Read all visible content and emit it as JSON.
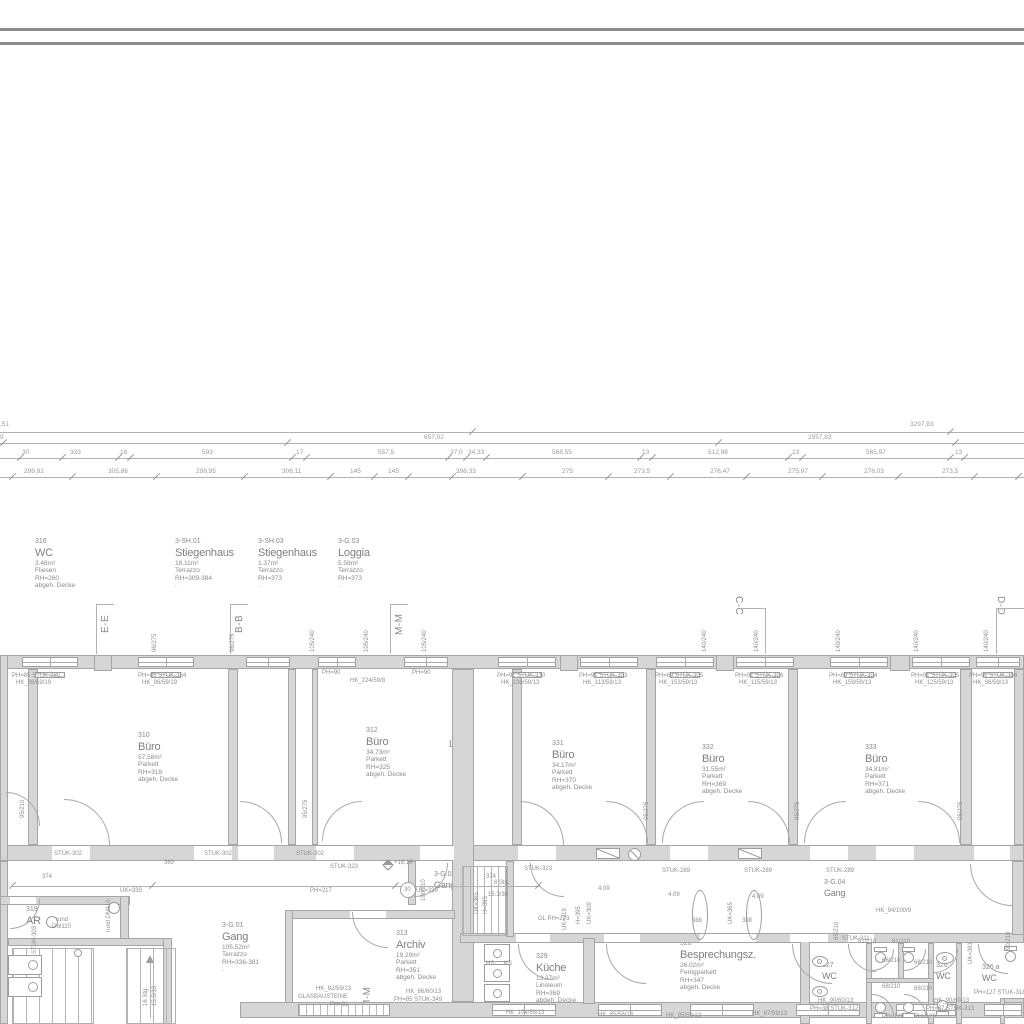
{
  "colors": {
    "wall_fill": "#d6d6d6",
    "wall_edge": "#a6a6a6",
    "line": "#b2b2b2",
    "text": "#8f8f8f",
    "border": "#8c8c8c"
  },
  "rooms": {
    "r316": {
      "num": "316",
      "name": "WC",
      "area": "3.48m²",
      "floor": "Fliesen",
      "rh": "RH=260",
      "ceiling": "abgeh. Decke"
    },
    "sh01": {
      "num": "3-SH.01",
      "name": "Stiegenhaus",
      "area": "18.11m²",
      "floor": "Terrazzo",
      "rh": "RH=309-384",
      "ceiling": "."
    },
    "sh03": {
      "num": "3-SH.03",
      "name": "Stiegenhaus",
      "area": "1.37m²",
      "floor": "Terrazzo",
      "rh": "RH=373",
      "ceiling": "."
    },
    "g03": {
      "num": "3-G.03",
      "name": "Loggia",
      "area": "5.58m²",
      "floor": "Terrazzo",
      "rh": "RH=373",
      "ceiling": "."
    },
    "r310": {
      "num": "310",
      "name": "Büro",
      "area": "57.58m²",
      "floor": "Parkett",
      "rh": "RH=318",
      "ceiling": "abgeh. Decke"
    },
    "r312": {
      "num": "312",
      "name": "Büro",
      "area": "34.73m²",
      "floor": "Parkett",
      "rh": "RH=325",
      "ceiling": "abgeh. Decke"
    },
    "r331": {
      "num": "331",
      "name": "Büro",
      "area": "34.17m²",
      "floor": "Parkett",
      "rh": "RH=370",
      "ceiling": "abgeh. Decke"
    },
    "r332": {
      "num": "332",
      "name": "Büro",
      "area": "31.55m²",
      "floor": "Parkett",
      "rh": "RH=369",
      "ceiling": "abgeh. Decke"
    },
    "r333": {
      "num": "333",
      "name": "Büro",
      "area": "34.81m²",
      "floor": "Parkett",
      "rh": "RH=371",
      "ceiling": "abgeh. Decke"
    },
    "g01": {
      "num": "3-G.01",
      "name": "Gang",
      "area": "105.52m²",
      "floor": "Terrazzo",
      "rh": "RH=336-381",
      "ceiling": "."
    },
    "r313": {
      "num": "313",
      "name": "Archiv",
      "area": "19.29m²",
      "floor": "Parkett",
      "rh": "RH=351",
      "ceiling": "abgeh. Decke"
    },
    "r329": {
      "num": "329",
      "name": "Küche",
      "area": "13.27m²",
      "floor": "Linoleum",
      "rh": "RH=369",
      "ceiling": "abgeh. Decke"
    },
    "r328": {
      "num": "328",
      "name": "Besprechungsz.",
      "area": "26.02m²",
      "floor": "Fertigparkett",
      "rh": "RH=347",
      "ceiling": "abgeh. Decke"
    },
    "r319": {
      "num": "319",
      "name": "AR"
    },
    "g02": {
      "num": "3-G.02",
      "name": "Gang"
    },
    "g04": {
      "num": "3-G.04",
      "name": "Gang"
    },
    "r327": {
      "num": "327",
      "name": "WC"
    },
    "r326": {
      "num": "326",
      "name": "WC"
    },
    "r326a": {
      "num": "326 a",
      "name": "WC"
    }
  },
  "section_markers": {
    "ee": "E-E",
    "bb": "B-B",
    "mm": "M-M",
    "cc": "C-C",
    "dd": "D-D",
    "ll": "L-L",
    "mm_bottom": "M-M"
  },
  "dimensions": {
    "rows": [
      [
        {
          "t": ",51",
          "x": 0
        },
        {
          "t": "3297,83",
          "x": 910
        }
      ],
      [
        {
          "t": "9",
          "x": 0
        },
        {
          "t": "657,02",
          "x": 424
        },
        {
          "t": "2557,83",
          "x": 808
        }
      ],
      [
        {
          "t": "30",
          "x": 22
        },
        {
          "t": "333",
          "x": 70
        },
        {
          "t": "18",
          "x": 120
        },
        {
          "t": "593",
          "x": 202
        },
        {
          "t": "17",
          "x": 296
        },
        {
          "t": "557,5",
          "x": 378
        },
        {
          "t": "37,0",
          "x": 450
        },
        {
          "t": "34,33",
          "x": 468
        },
        {
          "t": "568,55",
          "x": 552
        },
        {
          "t": "13",
          "x": 642
        },
        {
          "t": "512,98",
          "x": 708
        },
        {
          "t": "13",
          "x": 792
        },
        {
          "t": "565,97",
          "x": 866
        },
        {
          "t": "13",
          "x": 955
        }
      ],
      [
        {
          "t": "299,92",
          "x": 24
        },
        {
          "t": "305,86",
          "x": 108
        },
        {
          "t": "299,95",
          "x": 196
        },
        {
          "t": "306,11",
          "x": 282
        },
        {
          "t": "145",
          "x": 350
        },
        {
          "t": "145",
          "x": 388
        },
        {
          "t": "396,33",
          "x": 456
        },
        {
          "t": "275",
          "x": 562
        },
        {
          "t": "273,5",
          "x": 634
        },
        {
          "t": "276,47",
          "x": 710
        },
        {
          "t": "275,97",
          "x": 788
        },
        {
          "t": "276,03",
          "x": 864
        },
        {
          "t": "273,5",
          "x": 942
        }
      ]
    ]
  },
  "annotations": [
    {
      "t": "PH=85 STUK-380",
      "x": 12,
      "y": 673
    },
    {
      "t": "HK_86/59/19",
      "x": 16,
      "y": 680
    },
    {
      "t": "PH=85 STUK-384",
      "x": 138,
      "y": 673
    },
    {
      "t": "HK_96/59/19",
      "x": 142,
      "y": 680
    },
    {
      "t": "PH=90",
      "x": 322,
      "y": 670
    },
    {
      "t": "HK_224/59/8",
      "x": 350,
      "y": 678
    },
    {
      "t": "PH=90",
      "x": 412,
      "y": 670
    },
    {
      "t": "PH=91 STUK-310",
      "x": 497,
      "y": 673
    },
    {
      "t": "HK_136/59/13",
      "x": 501,
      "y": 680
    },
    {
      "t": "PH=91 STUK-303",
      "x": 579,
      "y": 673
    },
    {
      "t": "HK_113/59/13",
      "x": 583,
      "y": 680
    },
    {
      "t": "PH=89 STUK-305",
      "x": 655,
      "y": 673
    },
    {
      "t": "HK_153/59/13",
      "x": 659,
      "y": 680
    },
    {
      "t": "PH=91 STUK-306",
      "x": 735,
      "y": 673
    },
    {
      "t": "HK_115/59/13",
      "x": 739,
      "y": 680
    },
    {
      "t": "PH=89 STUK-304",
      "x": 829,
      "y": 673
    },
    {
      "t": "HK_159/59/13",
      "x": 833,
      "y": 680
    },
    {
      "t": "PH=91 STUK-305",
      "x": 911,
      "y": 673
    },
    {
      "t": "HK_125/59/13",
      "x": 915,
      "y": 680
    },
    {
      "t": "PH=96 STUK-304",
      "x": 969,
      "y": 673
    },
    {
      "t": "HK_96/59/13",
      "x": 973,
      "y": 680
    },
    {
      "t": "96/275",
      "x": 152,
      "y": 652,
      "r": -90
    },
    {
      "t": "96/275",
      "x": 230,
      "y": 652,
      "r": -90
    },
    {
      "t": "105/240",
      "x": 310,
      "y": 652,
      "r": -90
    },
    {
      "t": "105/240",
      "x": 364,
      "y": 652,
      "r": -90
    },
    {
      "t": "105/240",
      "x": 422,
      "y": 652,
      "r": -90
    },
    {
      "t": "140/240",
      "x": 702,
      "y": 652,
      "r": -90
    },
    {
      "t": "140/240",
      "x": 754,
      "y": 652,
      "r": -90
    },
    {
      "t": "140/240",
      "x": 836,
      "y": 652,
      "r": -90
    },
    {
      "t": "140/240",
      "x": 914,
      "y": 652,
      "r": -90
    },
    {
      "t": "140/240",
      "x": 984,
      "y": 652,
      "r": -90
    },
    {
      "t": "STUK-302",
      "x": 54,
      "y": 851
    },
    {
      "t": "STUK-302",
      "x": 204,
      "y": 851
    },
    {
      "t": "STUK-302",
      "x": 296,
      "y": 851
    },
    {
      "t": "369",
      "x": 164,
      "y": 860
    },
    {
      "t": "STUK-323",
      "x": 330,
      "y": 864
    },
    {
      "t": "STUK-323",
      "x": 524,
      "y": 866
    },
    {
      "t": "STUK-289",
      "x": 662,
      "y": 868
    },
    {
      "t": "STUK-289",
      "x": 744,
      "y": 868
    },
    {
      "t": "STUK-289",
      "x": 826,
      "y": 868
    },
    {
      "t": "95/275",
      "x": 303,
      "y": 818,
      "r": -90
    },
    {
      "t": "95/275",
      "x": 644,
      "y": 820,
      "r": -90
    },
    {
      "t": "95/275",
      "x": 795,
      "y": 820,
      "r": -90
    },
    {
      "t": "95/275",
      "x": 958,
      "y": 820,
      "r": -90
    },
    {
      "t": "95/210",
      "x": 20,
      "y": 818,
      "r": -90
    },
    {
      "t": "374",
      "x": 42,
      "y": 874
    },
    {
      "t": "374",
      "x": 486,
      "y": 874
    },
    {
      "t": "UK=339",
      "x": 120,
      "y": 888
    },
    {
      "t": "PH=217",
      "x": 310,
      "y": 888
    },
    {
      "t": "UK=339",
      "x": 416,
      "y": 888
    },
    {
      "t": "UK=319",
      "x": 562,
      "y": 930,
      "r": -90
    },
    {
      "t": "rund",
      "x": 56,
      "y": 917
    },
    {
      "t": "DM110",
      "x": 52,
      "y": 924
    },
    {
      "t": "rund DM110",
      "x": 106,
      "y": 932,
      "r": -90
    },
    {
      "t": "STUK-303",
      "x": 32,
      "y": 954,
      "r": -90
    },
    {
      "t": "+16,16",
      "x": 394,
      "y": 860
    },
    {
      "t": "100/210",
      "x": 421,
      "y": 901,
      "r": -90
    },
    {
      "t": "30",
      "x": 404,
      "y": 887
    },
    {
      "t": "6 Stg.",
      "x": 494,
      "y": 880
    },
    {
      "t": "15.3/30",
      "x": 488,
      "y": 892
    },
    {
      "t": "UK=365",
      "x": 474,
      "y": 914,
      "r": -90
    },
    {
      "t": "H=395",
      "x": 483,
      "y": 914,
      "r": -90
    },
    {
      "t": "H=395",
      "x": 576,
      "y": 924,
      "r": -90
    },
    {
      "t": "UK=309",
      "x": 587,
      "y": 924,
      "r": -90
    },
    {
      "t": "4.09",
      "x": 598,
      "y": 886
    },
    {
      "t": "GL PH=273",
      "x": 538,
      "y": 916
    },
    {
      "t": "HS",
      "x": 486,
      "y": 961
    },
    {
      "t": "KS",
      "x": 504,
      "y": 961
    },
    {
      "t": "HK_82/59/13",
      "x": 316,
      "y": 986
    },
    {
      "t": "GLASBAUSTEINE",
      "x": 298,
      "y": 994
    },
    {
      "t": "PH=91",
      "x": 330,
      "y": 1002
    },
    {
      "t": "HK_86/60/13",
      "x": 406,
      "y": 989
    },
    {
      "t": "PH=85 STUK-349",
      "x": 394,
      "y": 997
    },
    {
      "t": "HK_104/59/13",
      "x": 506,
      "y": 1010
    },
    {
      "t": "HK_85/58/13",
      "x": 598,
      "y": 1012
    },
    {
      "t": "HK_85/59/13",
      "x": 666,
      "y": 1013
    },
    {
      "t": "HK_87/59/13",
      "x": 752,
      "y": 1011
    },
    {
      "t": "16 Stg.",
      "x": 143,
      "y": 1006,
      "r": -90
    },
    {
      "t": "15.5/33",
      "x": 152,
      "y": 1006,
      "r": -90
    },
    {
      "t": "4.09",
      "x": 668,
      "y": 892
    },
    {
      "t": "4.09",
      "x": 752,
      "y": 894
    },
    {
      "t": "UK=365",
      "x": 728,
      "y": 924,
      "r": -90
    },
    {
      "t": "388",
      "x": 692,
      "y": 918
    },
    {
      "t": "388",
      "x": 742,
      "y": 918
    },
    {
      "t": "HK_94/100/9",
      "x": 876,
      "y": 908
    },
    {
      "t": "65/210",
      "x": 834,
      "y": 940,
      "r": -90
    },
    {
      "t": "STUK-311",
      "x": 842,
      "y": 936
    },
    {
      "t": "81/210",
      "x": 858,
      "y": 939
    },
    {
      "t": "81/210",
      "x": 892,
      "y": 939
    },
    {
      "t": "68/210",
      "x": 882,
      "y": 958
    },
    {
      "t": "68/210",
      "x": 882,
      "y": 984
    },
    {
      "t": "68/210",
      "x": 914,
      "y": 960
    },
    {
      "t": "68/210",
      "x": 914,
      "y": 986
    },
    {
      "t": "HK_90/60/13",
      "x": 818,
      "y": 998
    },
    {
      "t": "PH=38 STUK-312",
      "x": 810,
      "y": 1006
    },
    {
      "t": "HK_90/60/13",
      "x": 934,
      "y": 998
    },
    {
      "t": "PH=87 STUK-313",
      "x": 926,
      "y": 1006
    },
    {
      "t": "PH=129",
      "x": 882,
      "y": 1014
    },
    {
      "t": "PH=129",
      "x": 914,
      "y": 1014
    },
    {
      "t": "PH=127 STUK-318",
      "x": 974,
      "y": 990
    },
    {
      "t": "UK=381",
      "x": 968,
      "y": 964,
      "r": -90
    },
    {
      "t": "90/210",
      "x": 1006,
      "y": 950,
      "r": -90
    }
  ]
}
